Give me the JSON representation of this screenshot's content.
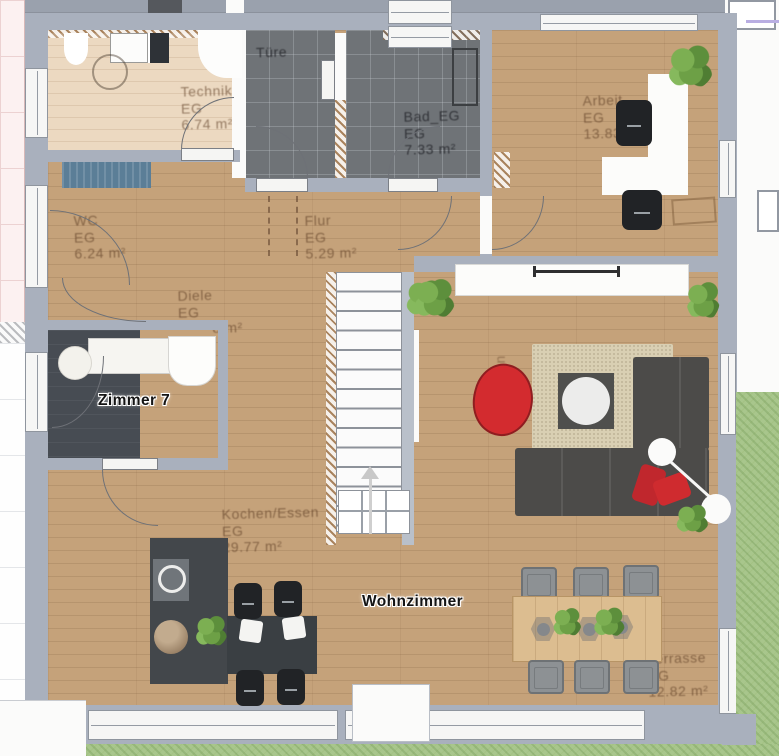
{
  "plan": {
    "floor_tag": "EG",
    "rooms": {
      "technik": {
        "name": "Technik",
        "floor": "EG",
        "area": "6.74 m²"
      },
      "tuerraum": {
        "name": "Türe",
        "floor": "",
        "area": ""
      },
      "bad": {
        "name": "Bad_EG",
        "floor": "EG",
        "area": "7.33 m²"
      },
      "arbeit": {
        "name": "Arbeit",
        "floor": "EG",
        "area": "13.83 m²"
      },
      "wc": {
        "name": "WC",
        "floor": "EG",
        "area": "6.24 m²"
      },
      "flur": {
        "name": "Flur",
        "floor": "EG",
        "area": "5.29 m²"
      },
      "diele": {
        "name": "Diele",
        "floor": "EG",
        "area": "8 m²"
      },
      "wohnen": {
        "name": "Wohn",
        "floor": "EG",
        "area": ""
      },
      "kochen_essen": {
        "name": "Kochen/Essen",
        "floor": "EG",
        "area": "29.77 m²"
      },
      "terrasse": {
        "name": "Terrasse",
        "floor": "EG",
        "area": "12.82 m²"
      }
    },
    "selected_labels": {
      "zimmer7": "Zimmer 7",
      "wohnzimmer": "Wohnzimmer"
    }
  },
  "colors": {
    "wall": "#a9b0bd",
    "wood": "#c5a27a",
    "wood_pale": "#ecd9c1",
    "tile": "#6f7377",
    "grass": "#a8c68c",
    "accent_red": "#cf2b2f",
    "rug": "#d9cfb3",
    "sofa": "#4c4b49",
    "mat_blue": "#5b7e97"
  }
}
